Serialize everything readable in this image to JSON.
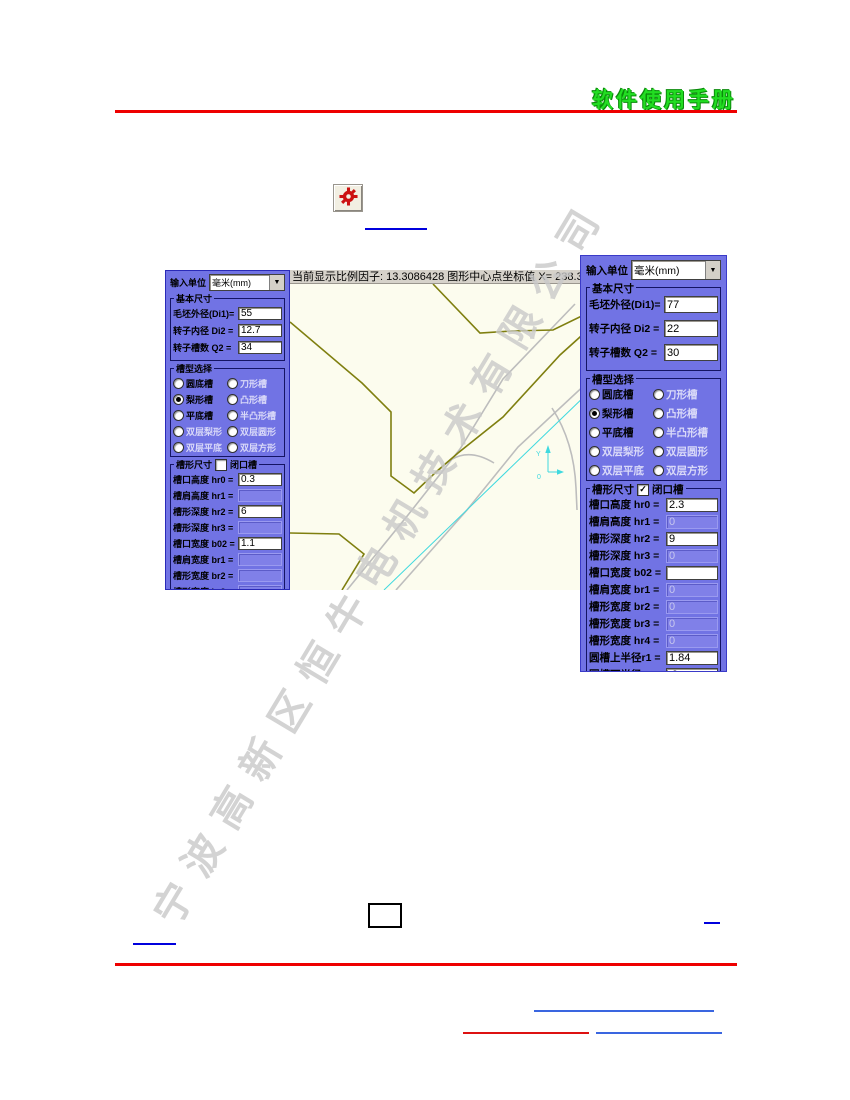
{
  "header": {
    "title": "软件使用手册"
  },
  "watermark": {
    "text": "宁波高新区恒牛电机技术有限公司"
  },
  "canvas": {
    "status_text": "当前显示比例因子: 13.3086428   图形中心点坐标值 X= 238.3"
  },
  "dialog_left": {
    "unit_label": "输入单位",
    "unit_value": "毫米(mm)",
    "basic_group": "基本尺寸",
    "basic_fields": [
      {
        "label": "毛坯外径(Di1)=",
        "value": "55",
        "enabled": true
      },
      {
        "label": "转子内径 Di2 =",
        "value": "12.7",
        "enabled": true
      },
      {
        "label": "转子槽数  Q2 =",
        "value": "34",
        "enabled": true
      }
    ],
    "slot_type_group": "槽型选择",
    "slot_types": [
      {
        "label": "圆底槽",
        "selected": false,
        "enabled": true
      },
      {
        "label": "刀形槽",
        "selected": false,
        "enabled": false
      },
      {
        "label": "梨形槽",
        "selected": true,
        "enabled": true
      },
      {
        "label": "凸形槽",
        "selected": false,
        "enabled": false
      },
      {
        "label": "平底槽",
        "selected": false,
        "enabled": true
      },
      {
        "label": "半凸形槽",
        "selected": false,
        "enabled": false
      },
      {
        "label": "双层梨形",
        "selected": false,
        "enabled": false
      },
      {
        "label": "双层圆形",
        "selected": false,
        "enabled": false
      },
      {
        "label": "双层平底",
        "selected": false,
        "enabled": false
      },
      {
        "label": "双层方形",
        "selected": false,
        "enabled": false
      }
    ],
    "slot_dim_group": "槽形尺寸",
    "closed_slot_label": "闭口槽",
    "closed_slot_checked": false,
    "dim_fields": [
      {
        "label": "槽口高度 hr0 =",
        "value": "0.3",
        "enabled": true
      },
      {
        "label": "槽肩高度 hr1 =",
        "value": "",
        "enabled": false
      },
      {
        "label": "槽形深度 hr2 =",
        "value": "6",
        "enabled": true
      },
      {
        "label": "槽形深度 hr3 =",
        "value": "",
        "enabled": false
      },
      {
        "label": "槽口宽度 b02 =",
        "value": "1.1",
        "enabled": true
      },
      {
        "label": "槽肩宽度 br1 =",
        "value": "",
        "enabled": false
      },
      {
        "label": "槽形宽度 br2 =",
        "value": "",
        "enabled": false
      },
      {
        "label": "槽形宽度 br3 =",
        "value": "",
        "enabled": false
      },
      {
        "label": "槽形宽度 hr4 =",
        "value": "",
        "enabled": false
      },
      {
        "label": "圆槽上半径r1 =",
        "value": "1",
        "enabled": true
      }
    ]
  },
  "dialog_right": {
    "unit_label": "输入单位",
    "unit_value": "毫米(mm)",
    "basic_group": "基本尺寸",
    "basic_fields": [
      {
        "label": "毛坯外径(Di1)=",
        "value": "77",
        "enabled": true
      },
      {
        "label": "转子内径 Di2 =",
        "value": "22",
        "enabled": true
      },
      {
        "label": "转子槽数  Q2 =",
        "value": "30",
        "enabled": true
      }
    ],
    "slot_type_group": "槽型选择",
    "slot_types": [
      {
        "label": "圆底槽",
        "selected": false,
        "enabled": true
      },
      {
        "label": "刀形槽",
        "selected": false,
        "enabled": false
      },
      {
        "label": "梨形槽",
        "selected": true,
        "enabled": true
      },
      {
        "label": "凸形槽",
        "selected": false,
        "enabled": false
      },
      {
        "label": "平底槽",
        "selected": false,
        "enabled": true
      },
      {
        "label": "半凸形槽",
        "selected": false,
        "enabled": false
      },
      {
        "label": "双层梨形",
        "selected": false,
        "enabled": false
      },
      {
        "label": "双层圆形",
        "selected": false,
        "enabled": false
      },
      {
        "label": "双层平底",
        "selected": false,
        "enabled": false
      },
      {
        "label": "双层方形",
        "selected": false,
        "enabled": false
      }
    ],
    "slot_dim_group": "槽形尺寸",
    "closed_slot_label": "闭口槽",
    "closed_slot_checked": true,
    "dim_fields": [
      {
        "label": "槽口高度 hr0 =",
        "value": "2.3",
        "enabled": true
      },
      {
        "label": "槽肩高度 hr1 =",
        "value": "0",
        "enabled": false
      },
      {
        "label": "槽形深度 hr2 =",
        "value": "9",
        "enabled": true
      },
      {
        "label": "槽形深度 hr3 =",
        "value": "0",
        "enabled": false
      },
      {
        "label": "槽口宽度 b02 =",
        "value": "",
        "enabled": true
      },
      {
        "label": "槽肩宽度 br1 =",
        "value": "0",
        "enabled": false
      },
      {
        "label": "槽形宽度 br2 =",
        "value": "0",
        "enabled": false
      },
      {
        "label": "槽形宽度 br3 =",
        "value": "0",
        "enabled": false
      },
      {
        "label": "槽形宽度 hr4 =",
        "value": "0",
        "enabled": false
      },
      {
        "label": "圆槽上半径r1 =",
        "value": "1.84",
        "enabled": true
      },
      {
        "label": "圆槽下半径r2 =",
        "value": ".9",
        "enabled": true
      }
    ],
    "buttons": [
      {
        "label": "信  息"
      },
      {
        "label": "设  计"
      }
    ]
  },
  "colors": {
    "panel": "#7173E4",
    "title_green": "#22DD22",
    "rule_red": "#EE0000",
    "link_blue": "#0000DD",
    "footer_blue": "#3A66E0",
    "footer_red": "#DD1111",
    "olive": "#7F7F0F",
    "drawing_bg": "#FCFCEE",
    "statusbar_bg": "#D6D2CA",
    "gray_line": "#BDBDBD",
    "cyan_line": "#3FD9DF",
    "watermark_gray": "#C9C9C9",
    "button_face": "#ECE9D8",
    "disabled_box": "#8080E8",
    "gear_red": "#CC1111"
  }
}
